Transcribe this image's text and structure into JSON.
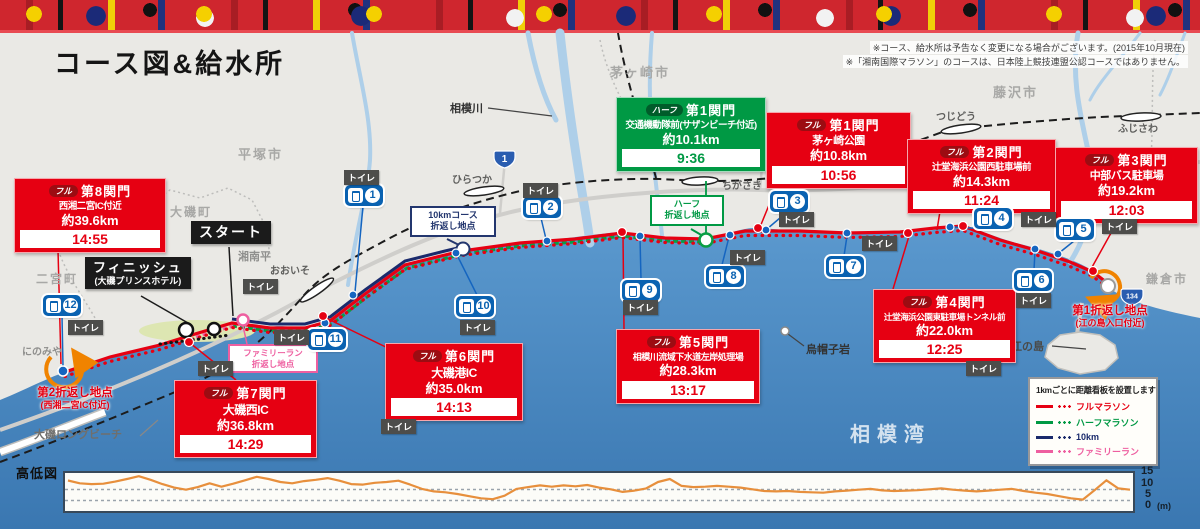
{
  "header": {
    "title": "コース図&給水所",
    "notes": [
      "※コース、給水所は予告なく変更になる場合がございます。(2015年10月現在)",
      "※「湘南国際マラソン」のコースは、日本陸上競技連盟公認コースではありません。"
    ]
  },
  "map": {
    "cities": [
      "平塚市",
      "茅ヶ崎市",
      "藤沢市",
      "鎌倉市",
      "大磯町",
      "二宮町"
    ],
    "areas": [
      "湘南平",
      "にのみや",
      "大磯ロングビーチ",
      "相模湾",
      "江の島",
      "烏帽子岩",
      "相模川"
    ],
    "stations": [
      "ひらつか",
      "おおいそ",
      "ちがさき",
      "つじどう",
      "ふじさわ"
    ],
    "shields": [
      "1",
      "134"
    ]
  },
  "checkpoints": [
    {
      "badge": "フル",
      "name": "第8関門",
      "location": "西湘二宮IC付近",
      "distance": "約39.6km",
      "time": "14:55",
      "type": "full"
    },
    {
      "badge": "ハーフ",
      "name": "第1関門",
      "location": "交通機動隊前(サザンビーチ付近)",
      "distance": "約10.1km",
      "time": "9:36",
      "type": "half"
    },
    {
      "badge": "フル",
      "name": "第1関門",
      "location": "茅ヶ崎公園",
      "distance": "約10.8km",
      "time": "10:56",
      "type": "full"
    },
    {
      "badge": "フル",
      "name": "第2関門",
      "location": "辻堂海浜公園西駐車場前",
      "distance": "約14.3km",
      "time": "11:24",
      "type": "full"
    },
    {
      "badge": "フル",
      "name": "第3関門",
      "location": "中部バス駐車場",
      "distance": "約19.2km",
      "time": "12:03",
      "type": "full"
    },
    {
      "badge": "フル",
      "name": "第4関門",
      "location": "辻堂海浜公園東駐車場トンネル前",
      "distance": "約22.0km",
      "time": "12:25",
      "type": "full"
    },
    {
      "badge": "フル",
      "name": "第5関門",
      "location": "相模川流域下水道左岸処理場",
      "distance": "約28.3km",
      "time": "13:17",
      "type": "full"
    },
    {
      "badge": "フル",
      "name": "第6関門",
      "location": "大磯港IC",
      "distance": "約35.0km",
      "time": "14:13",
      "type": "full"
    },
    {
      "badge": "フル",
      "name": "第7関門",
      "location": "大磯西IC",
      "distance": "約36.8km",
      "time": "14:29",
      "type": "full"
    }
  ],
  "markers": {
    "start": "スタート",
    "finish_title": "フィニッシュ",
    "finish_sub": "(大磯プリンスホテル)",
    "turn_10km": [
      "10kmコース",
      "折返し地点"
    ],
    "turn_half": [
      "ハーフ",
      "折返し地点"
    ],
    "turn_family": [
      "ファミリーラン",
      "折返し地点"
    ],
    "turn_1": [
      "第1折返し地点",
      "(江の島入口付近)"
    ],
    "turn_2": [
      "第2折返し地点",
      "(西湘二宮IC付近)"
    ],
    "toilet": "トイレ"
  },
  "water_stations": [
    "1",
    "2",
    "3",
    "4",
    "5",
    "6",
    "7",
    "8",
    "9",
    "10",
    "11",
    "12"
  ],
  "legend": {
    "title": "1kmごとに距離看板を設置します",
    "items": [
      {
        "label": "フルマラソン",
        "color": "#e60012"
      },
      {
        "label": "ハーフマラソン",
        "color": "#009944"
      },
      {
        "label": "10km",
        "color": "#1a2a6c"
      },
      {
        "label": "ファミリーラン",
        "color": "#ee5fa0"
      }
    ]
  },
  "elevation": {
    "label": "高低図",
    "yticks": [
      "15",
      "10",
      "5",
      "0"
    ],
    "unit": "(m)",
    "profile_m": [
      13.5,
      12.2,
      11.8,
      12.0,
      13.0,
      14.2,
      15.5,
      13.8,
      11.8,
      10.2,
      9.2,
      10.4,
      12.2,
      10.6,
      12.0,
      13.6,
      15.2,
      14.2,
      12.8,
      12.2,
      13.2,
      13.8,
      14.6,
      13.4,
      11.8,
      11.6,
      12.4,
      12.8,
      13.4,
      11.6,
      9.6,
      8.4,
      8.0,
      7.2,
      6.2,
      5.2,
      4.8,
      6.4,
      9.6,
      10.4,
      11.2,
      10.6,
      11.2,
      10.8,
      11.4,
      10.2,
      9.4,
      8.2,
      8.8,
      9.8,
      12.8,
      14.2,
      11.0,
      10.4,
      10.6,
      11.0,
      10.6,
      10.2,
      9.4,
      8.6,
      8.4,
      8.6,
      8.2,
      8.0,
      7.8,
      8.4,
      8.8,
      9.2,
      9.6,
      8.9,
      8.6,
      8.8,
      9.0,
      9.4,
      9.8,
      9.2,
      8.8,
      8.4,
      8.8,
      9.2,
      9.6,
      8.6,
      7.8,
      7.2,
      6.2,
      5.2,
      4.6,
      9.0,
      13.6,
      9.8,
      9.2
    ]
  },
  "chart_data": {
    "type": "line",
    "title": "高低図",
    "ylabel": "(m)",
    "yticks": [
      15,
      10,
      5,
      0
    ],
    "ylim": [
      0,
      17
    ],
    "x_km_range": [
      0,
      42
    ],
    "series": [
      {
        "name": "elevation",
        "values": [
          13.5,
          12.2,
          11.8,
          12.0,
          13.0,
          14.2,
          15.5,
          13.8,
          11.8,
          10.2,
          9.2,
          10.4,
          12.2,
          10.6,
          12.0,
          13.6,
          15.2,
          14.2,
          12.8,
          12.2,
          13.2,
          13.8,
          14.6,
          13.4,
          11.8,
          11.6,
          12.4,
          12.8,
          13.4,
          11.6,
          9.6,
          8.4,
          8.0,
          7.2,
          6.2,
          5.2,
          4.8,
          6.4,
          9.6,
          10.4,
          11.2,
          10.6,
          11.2,
          10.8,
          11.4,
          10.2,
          9.4,
          8.2,
          8.8,
          9.8,
          12.8,
          14.2,
          11.0,
          10.4,
          10.6,
          11.0,
          10.6,
          10.2,
          9.4,
          8.6,
          8.4,
          8.6,
          8.2,
          8.0,
          7.8,
          8.4,
          8.8,
          9.2,
          9.6,
          8.9,
          8.6,
          8.8,
          9.0,
          9.4,
          9.8,
          9.2,
          8.8,
          8.4,
          8.8,
          9.2,
          9.6,
          8.6,
          7.8,
          7.2,
          6.2,
          5.2,
          4.6,
          9.0,
          13.6,
          9.8,
          9.2
        ]
      }
    ]
  }
}
